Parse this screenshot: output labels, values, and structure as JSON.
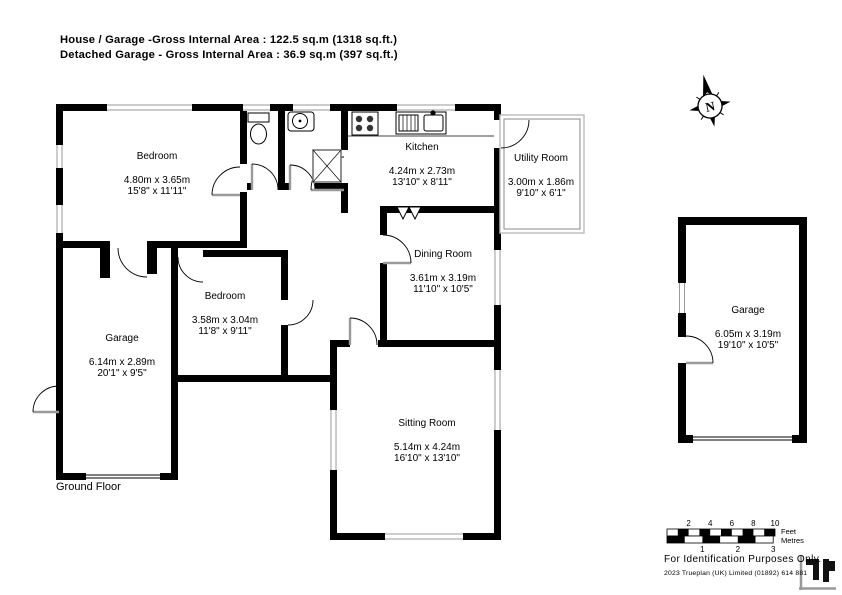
{
  "title": {
    "line1": "House / Garage -Gross Internal Area  :  122.5 sq.m  (1318 sq.ft.)",
    "line2": "Detached Garage - Gross Internal Area  :  36.9 sq.m  (397 sq.ft.)"
  },
  "floor_label": "Ground Floor",
  "rooms": [
    {
      "name": "Bedroom",
      "metric": "4.80m  x  3.65m",
      "imperial": "15'8\"  x  11'11\""
    },
    {
      "name": "Kitchen",
      "metric": "4.24m  x  2.73m",
      "imperial": "13'10\"  x  8'11\""
    },
    {
      "name": "Utility Room",
      "metric": "3.00m  x  1.86m",
      "imperial": "9'10\"  x  6'1\""
    },
    {
      "name": "Dining Room",
      "metric": "3.61m  x  3.19m",
      "imperial": "11'10\"  x  10'5\""
    },
    {
      "name": "Bedroom",
      "metric": "3.58m  x  3.04m",
      "imperial": "11'8\"  x  9'11\""
    },
    {
      "name": "Garage",
      "metric": "6.14m  x  2.89m",
      "imperial": "20'1\"  x  9'5\""
    },
    {
      "name": "Sitting Room",
      "metric": "5.14m  x  4.24m",
      "imperial": "16'10\"  x  13'10\""
    },
    {
      "name": "Garage",
      "metric": "6.05m  x  3.19m",
      "imperial": "19'10\"  x  10'5\""
    }
  ],
  "compass": {
    "label": "N"
  },
  "scale": {
    "feet_ticks": [
      "2",
      "4",
      "6",
      "8",
      "10"
    ],
    "metre_ticks": [
      "1",
      "2",
      "3"
    ],
    "feet_label": "Feet",
    "metres_label": "Metres"
  },
  "footer": {
    "line1": "For  Identification  Purposes  Only.",
    "line2": "2023 Trueplan (UK) Limited   (01892) 614 881"
  },
  "colors": {
    "wall": "#000000",
    "door_leaf": "#9a9a9a",
    "window_line": "#999999"
  }
}
